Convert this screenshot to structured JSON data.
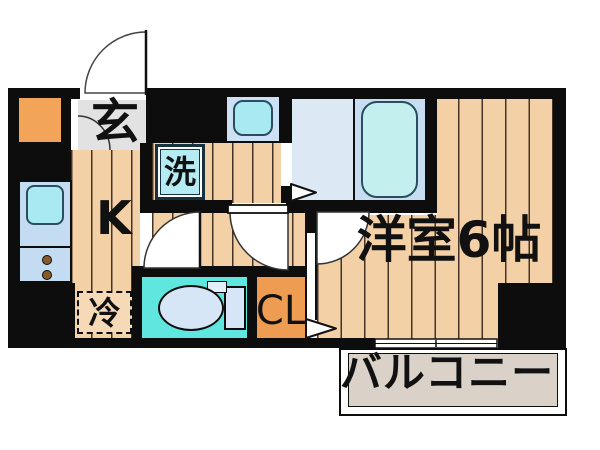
{
  "floorplan": {
    "title": "1K apartment floor plan",
    "labels": {
      "entrance": "玄",
      "kitchen": "K",
      "washer": "洗",
      "refrigerator": "冷",
      "closet": "CL",
      "main_room": "洋室6帖",
      "balcony": "バルコニー"
    },
    "colors": {
      "wall": "#0d0d0d",
      "wood": "#f4d0a6",
      "plank": "#453426",
      "genkan_floor": "#e2e2e2",
      "meter_box": "#f2a559",
      "closet_floor": "#ee9c52",
      "kitchen_counter": "#c3dcf2",
      "sink": "#a9eaf2",
      "fixture_border": "#2b4d5e",
      "washer_fill": "#b5ebf2",
      "washer_border": "#16323e",
      "bath_floor": "#dde8f5",
      "tub_panel": "#c7ddf2",
      "tub_fill": "#c3f0ee",
      "toilet_floor": "#5fe7df",
      "toilet_fixture": "#d6e6f6",
      "balcony_floor": "#dad2c8",
      "fridge_fill": "#f6d9b6",
      "stove_knob": "#8a5a28"
    }
  }
}
